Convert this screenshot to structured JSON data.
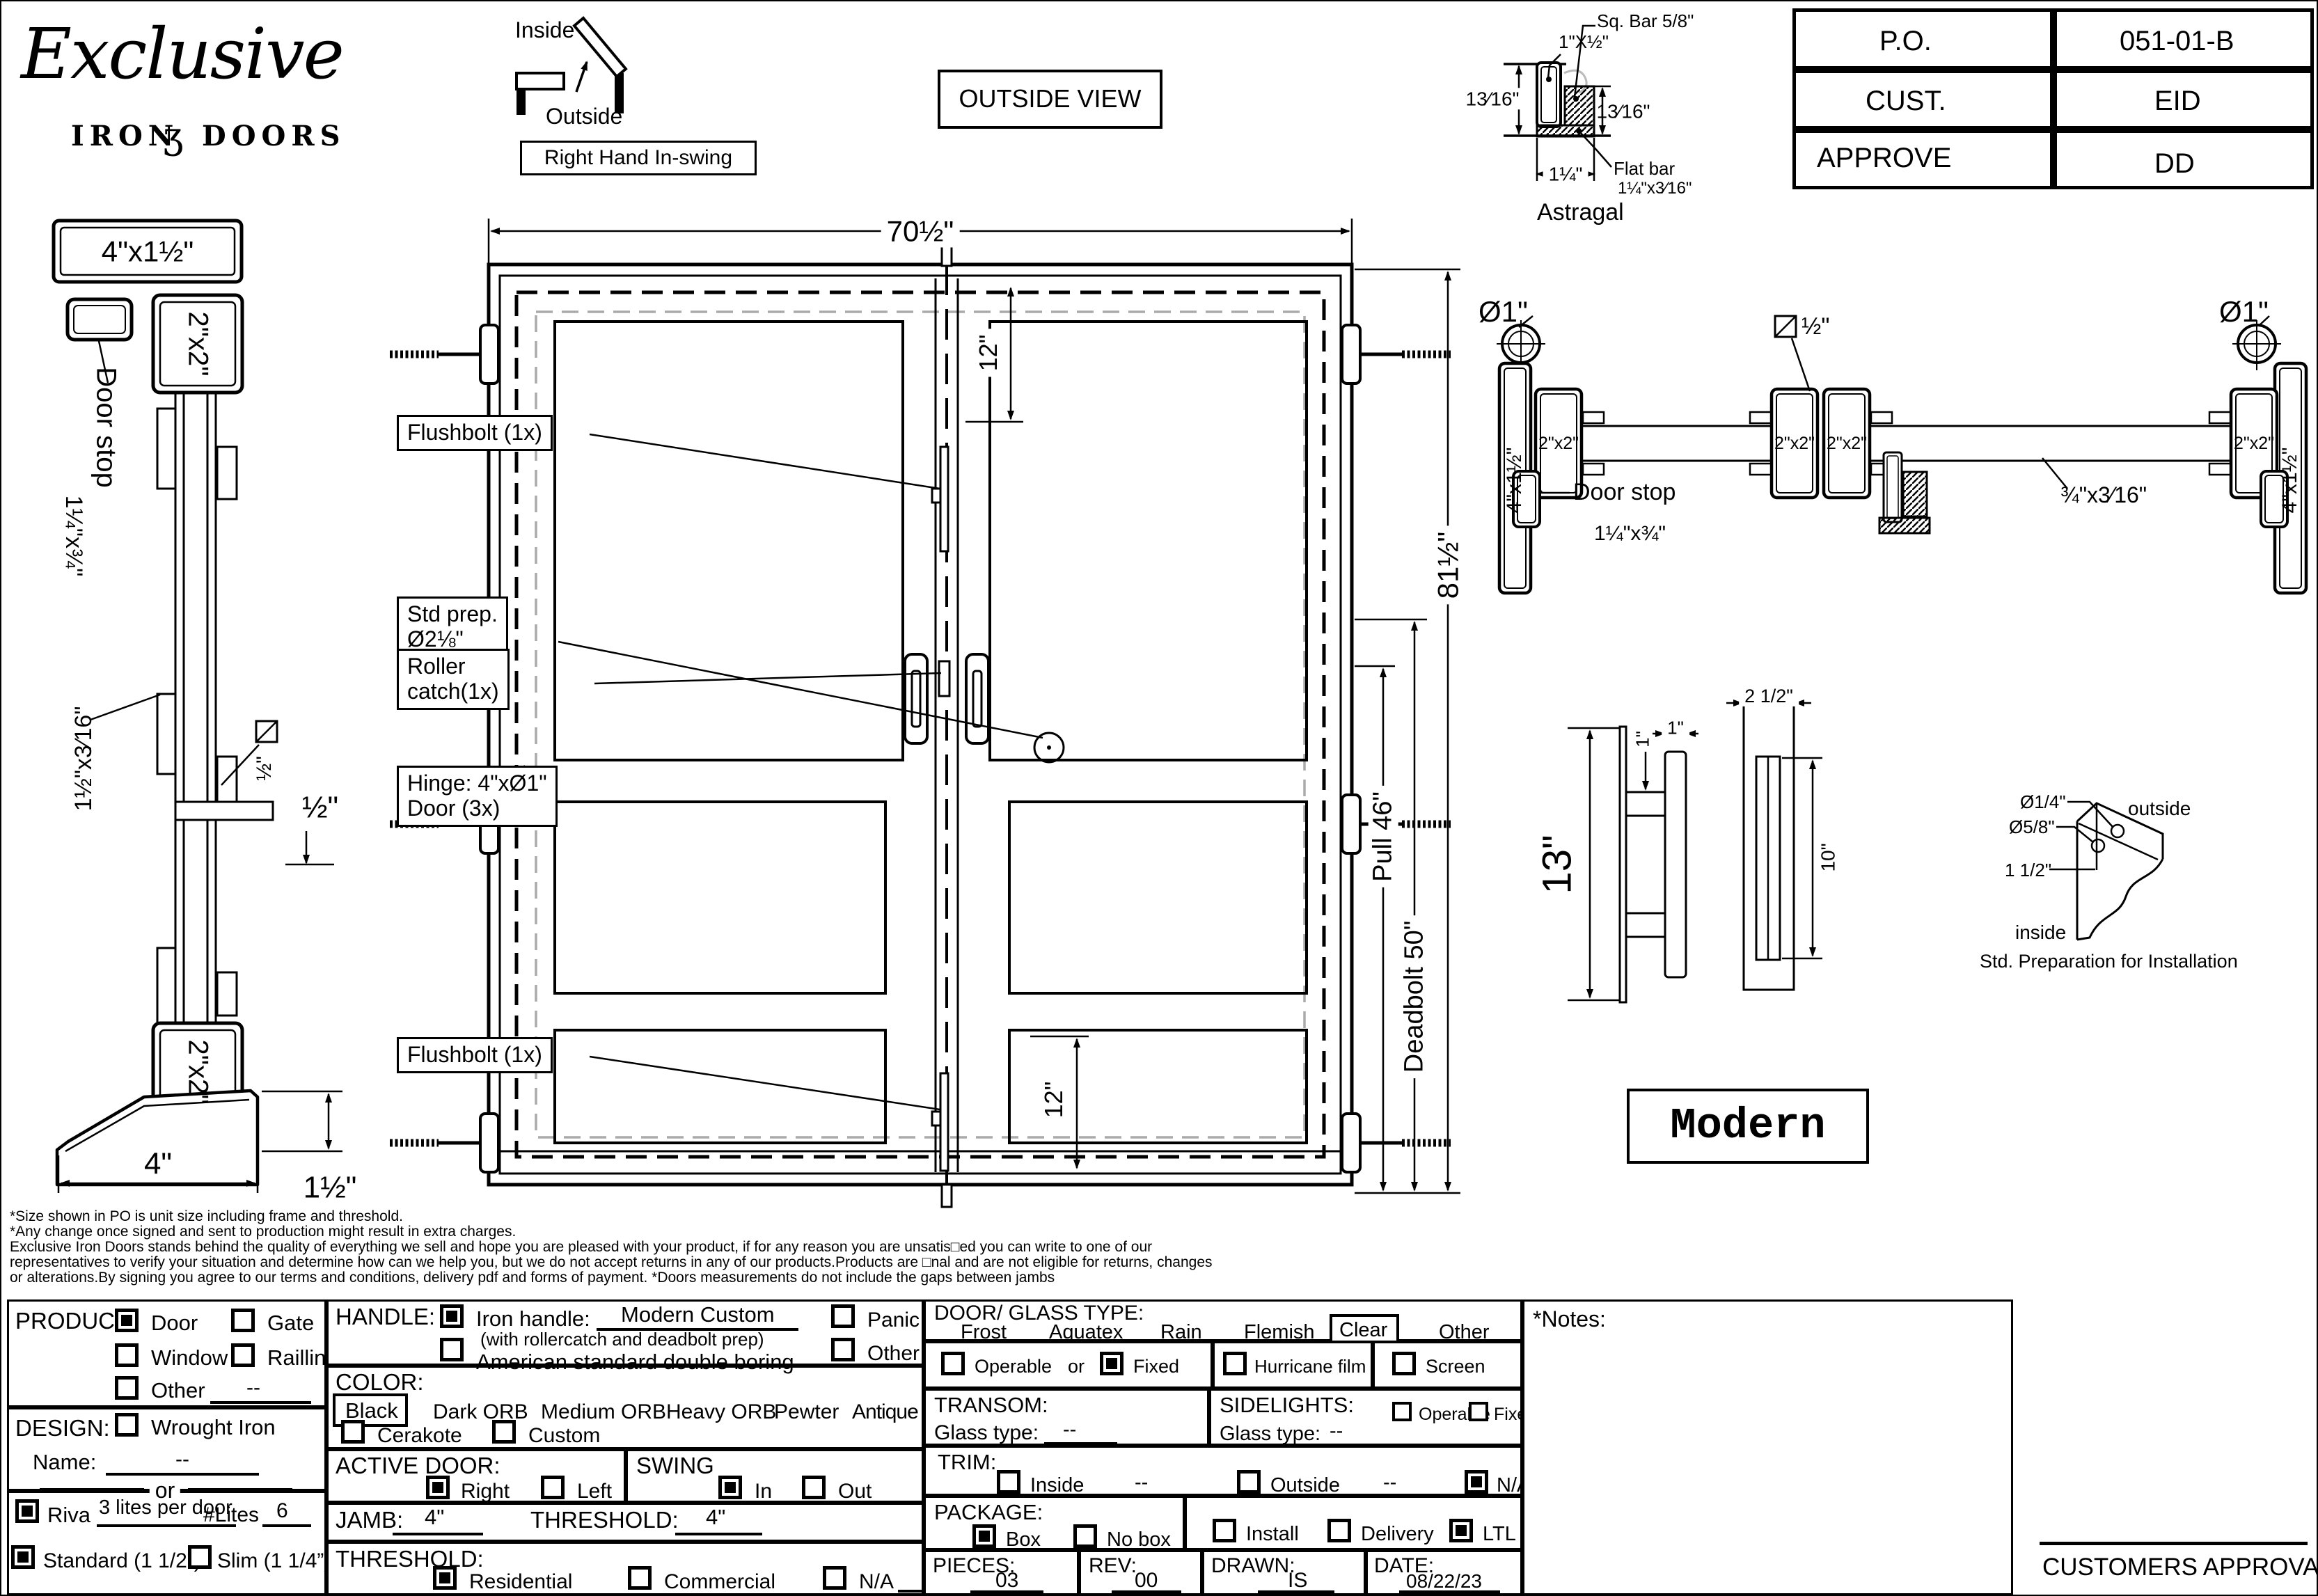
{
  "logo": {
    "script": "Exclusive",
    "word1": "IRON",
    "ornament": "ʒ",
    "word2": "DOORS"
  },
  "header": {
    "inside": "Inside",
    "outside": "Outside",
    "swing_label": "Right Hand In-swing",
    "view_label": "OUTSIDE VIEW"
  },
  "title_block": {
    "po_label": "P.O.",
    "po_value": "051-01-B",
    "cust_label": "CUST.",
    "cust_value": "EID",
    "approve_label": "APPROVE",
    "approve_value": "DD"
  },
  "astragal": {
    "sq_bar": "Sq. Bar 5/8\"",
    "tube": "1\"X½\"",
    "height_left": "13⁄16\"",
    "height_right": "13⁄16\"",
    "width": "1¼\"",
    "flat_bar_1": "Flat bar",
    "flat_bar_2": "1¼\"x3⁄16\"",
    "caption": "Astragal"
  },
  "jamb_section": {
    "tube": "4\"x1½\"",
    "frame_top": "2\"x2\"",
    "door_stop_1": "Door stop",
    "door_stop_2": "1¼\"x¾\"",
    "flat": "1½\"x3⁄16\"",
    "sq": "½\"",
    "frame_bottom": "2\"x2\"",
    "gap": "½\"",
    "base_width": "4\"",
    "base_height": "1½\""
  },
  "elevation": {
    "width": "70½\"",
    "height": "81½\"",
    "top_offset": "12\"",
    "bottom_offset": "12\"",
    "pull": "Pull 46\"",
    "deadbolt": "Deadbolt 50\"",
    "flushbolt_top": "Flushbolt (1x)",
    "std_prep_1": "Std prep.",
    "std_prep_2": "Ø2⅛\"",
    "roller_1": "Roller",
    "roller_2": "catch(1x)",
    "hinge_1": "Hinge: 4\"xØ1\"",
    "hinge_2": "Door (3x)"
  },
  "plan_section": {
    "hinge_dia_left": "Ø1\"",
    "hinge_dia_right": "Ø1\"",
    "sq_bar": "½\"",
    "tube_left": "4\"x1½\"",
    "tube_right": "4\"x1½\"",
    "stile1": "2\"x2\"",
    "stile2": "2\"x2\"",
    "stile3": "2\"x2\"",
    "stile4": "2\"x2\"",
    "door_stop": "Door stop",
    "door_stop_size": "1¼\"x¾\"",
    "flat_bar": "¾\"x3⁄16\""
  },
  "handle_detail": {
    "height": "13\"",
    "post_w": "1\"",
    "grip_w": "1\"",
    "plate_w": "2 1/2\"",
    "grip_h": "10\"",
    "style": "Modern"
  },
  "install_detail": {
    "d1": "Ø1/4\"",
    "d2": "Ø5/8\"",
    "d3": "1 1/2\"",
    "outside": "outside",
    "inside": "inside",
    "caption": "Std. Preparation for Installation"
  },
  "disclaimer": {
    "line1": "*Size shown in PO is unit size including frame and threshold.",
    "line2": "*Any change once signed and sent to production might result in extra charges.",
    "line3": "Exclusive Iron Doors stands behind the quality of everything we sell and hope you are pleased with your product, if for any reason you are unsatis□ed you can write to one of our",
    "line4": "representatives to verify your situation and determine how can we help you, but we do not accept returns in any of our products.Products are □nal and are not eligible for returns, changes",
    "line5": "or alterations.By signing you agree to our terms and conditions, delivery pdf and forms of payment. *Doors measurements do not include the gaps between jambs"
  },
  "form": {
    "product": {
      "label": "PRODUCT:",
      "door": {
        "label": "Door",
        "checked": true
      },
      "gate": {
        "label": "Gate",
        "checked": false
      },
      "window": {
        "label": "Window",
        "checked": false
      },
      "railling": {
        "label": "Railling",
        "checked": false
      },
      "other": {
        "label": "Other",
        "checked": false
      },
      "other_value": "--"
    },
    "design": {
      "label": "DESIGN:",
      "wrought": {
        "label": "Wrought Iron",
        "checked": false
      },
      "name_label": "Name:",
      "name_value": "--",
      "or_label": "or",
      "riva": {
        "label": "Riva",
        "checked": true
      },
      "riva_note": "3 lites per door",
      "lites_label": "#Lites",
      "lites_value": "6",
      "standard": {
        "label": "Standard (1 1/2”)",
        "checked": true
      },
      "slim": {
        "label": "Slim (1 1/4”)",
        "checked": false
      }
    },
    "handle": {
      "label": "HANDLE:",
      "iron": {
        "label": "Iron handle:",
        "checked": true
      },
      "iron_value": "Modern Custom",
      "iron_note": "(with rollercatch and deadbolt prep)",
      "american": {
        "label": "American standard double boring",
        "checked": false
      },
      "panic": {
        "label": "Panic hardware",
        "checked": false
      },
      "other": {
        "label": "Other",
        "checked": false
      }
    },
    "color": {
      "label": "COLOR:",
      "opt1": "Black",
      "opt2": "Dark ORB",
      "opt3": "Medium ORB",
      "opt4": "Heavy ORB",
      "opt5": "Pewter",
      "opt6": "Antique gold",
      "selected": "Black",
      "cerakote": {
        "label": "Cerakote",
        "checked": false
      },
      "custom": {
        "label": "Custom",
        "checked": false
      }
    },
    "active_door": {
      "label": "ACTIVE DOOR:",
      "right": {
        "label": "Right",
        "checked": true
      },
      "left": {
        "label": "Left",
        "checked": false
      }
    },
    "swing": {
      "label": "SWING",
      "in": {
        "label": "In",
        "checked": true
      },
      "out": {
        "label": "Out",
        "checked": false
      }
    },
    "jamb": {
      "label": "JAMB:",
      "value": "4\""
    },
    "threshold_dim": {
      "label": "THRESHOLD:",
      "value": "4\""
    },
    "threshold": {
      "label": "THRESHOLD:",
      "residential": {
        "label": "Residential",
        "checked": true
      },
      "commercial": {
        "label": "Commercial",
        "checked": false
      },
      "na": {
        "label": "N/A",
        "checked": false
      }
    },
    "glass": {
      "label": "DOOR/ GLASS TYPE:",
      "opt1": "Frost",
      "opt2": "Aquatex",
      "opt3": "Rain",
      "opt4": "Flemish",
      "opt5": "Clear",
      "opt6": "Other",
      "selected": "Clear"
    },
    "glazing": {
      "operable": {
        "label": "Operable",
        "checked": false
      },
      "or_label": "or",
      "fixed": {
        "label": "Fixed",
        "checked": true
      },
      "hurricane": {
        "label": "Hurricane film",
        "checked": false
      },
      "screen": {
        "label": "Screen",
        "checked": false
      }
    },
    "transom": {
      "label": "TRANSOM:",
      "glass_label": "Glass type:",
      "value": "--"
    },
    "sidelights": {
      "label": "SIDELIGHTS:",
      "glass_label": "Glass type:",
      "value": "--",
      "operable": {
        "label": "Operable",
        "checked": false
      },
      "fixed": {
        "label": "Fixed",
        "checked": false
      }
    },
    "trim": {
      "label": "TRIM:",
      "inside": {
        "label": "Inside",
        "checked": false
      },
      "inside_value": "--",
      "outside": {
        "label": "Outside",
        "checked": false
      },
      "outside_value": "--",
      "na": {
        "label": "N/A",
        "checked": true
      }
    },
    "package": {
      "label": "PACKAGE:",
      "box": {
        "label": "Box",
        "checked": true
      },
      "no_box": {
        "label": "No box",
        "checked": false
      }
    },
    "shipping": {
      "install": {
        "label": "Install",
        "checked": false
      },
      "delivery": {
        "label": "Delivery",
        "checked": false
      },
      "ltl": {
        "label": "LTL",
        "checked": true
      }
    },
    "pieces": {
      "label": "PIECES:",
      "value": "03"
    },
    "rev": {
      "label": "REV:",
      "value": "00"
    },
    "drawn": {
      "label": "DRAWN:",
      "value": "IS"
    },
    "date": {
      "label": "DATE:",
      "value": "08/22/23"
    },
    "notes_label": "*Notes:",
    "approval_label": "CUSTOMERS APPROVAL"
  }
}
